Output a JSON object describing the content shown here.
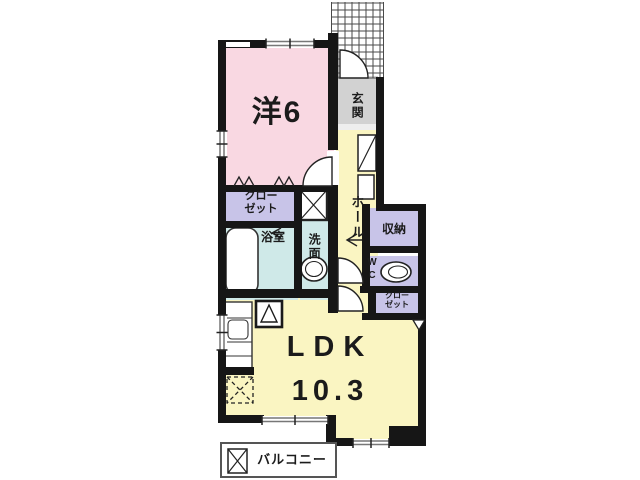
{
  "plan": {
    "rooms": {
      "western_room": {
        "label": "洋6"
      },
      "entrance": {
        "label": "玄関"
      },
      "hall": {
        "label": "ホール"
      },
      "closet_main": {
        "label": "クロー\nゼット"
      },
      "bathroom": {
        "label": "浴室"
      },
      "washroom": {
        "label": "洗面"
      },
      "storage": {
        "label": "収納"
      },
      "toilet": {
        "label": "W\nC"
      },
      "closet_ldk": {
        "label": "クロー\nゼット"
      },
      "ldk": {
        "label": "LDK",
        "size": "10.3"
      },
      "balcony": {
        "label": "バルコニー"
      }
    },
    "colors": {
      "room_pink": "#f9d8e2",
      "room_yellow": "#faf5c2",
      "room_lavender": "#c8c4e8",
      "room_cyan": "#cfe9e8",
      "entrance_gray": "#d2d2d2",
      "wall": "#161616"
    }
  }
}
